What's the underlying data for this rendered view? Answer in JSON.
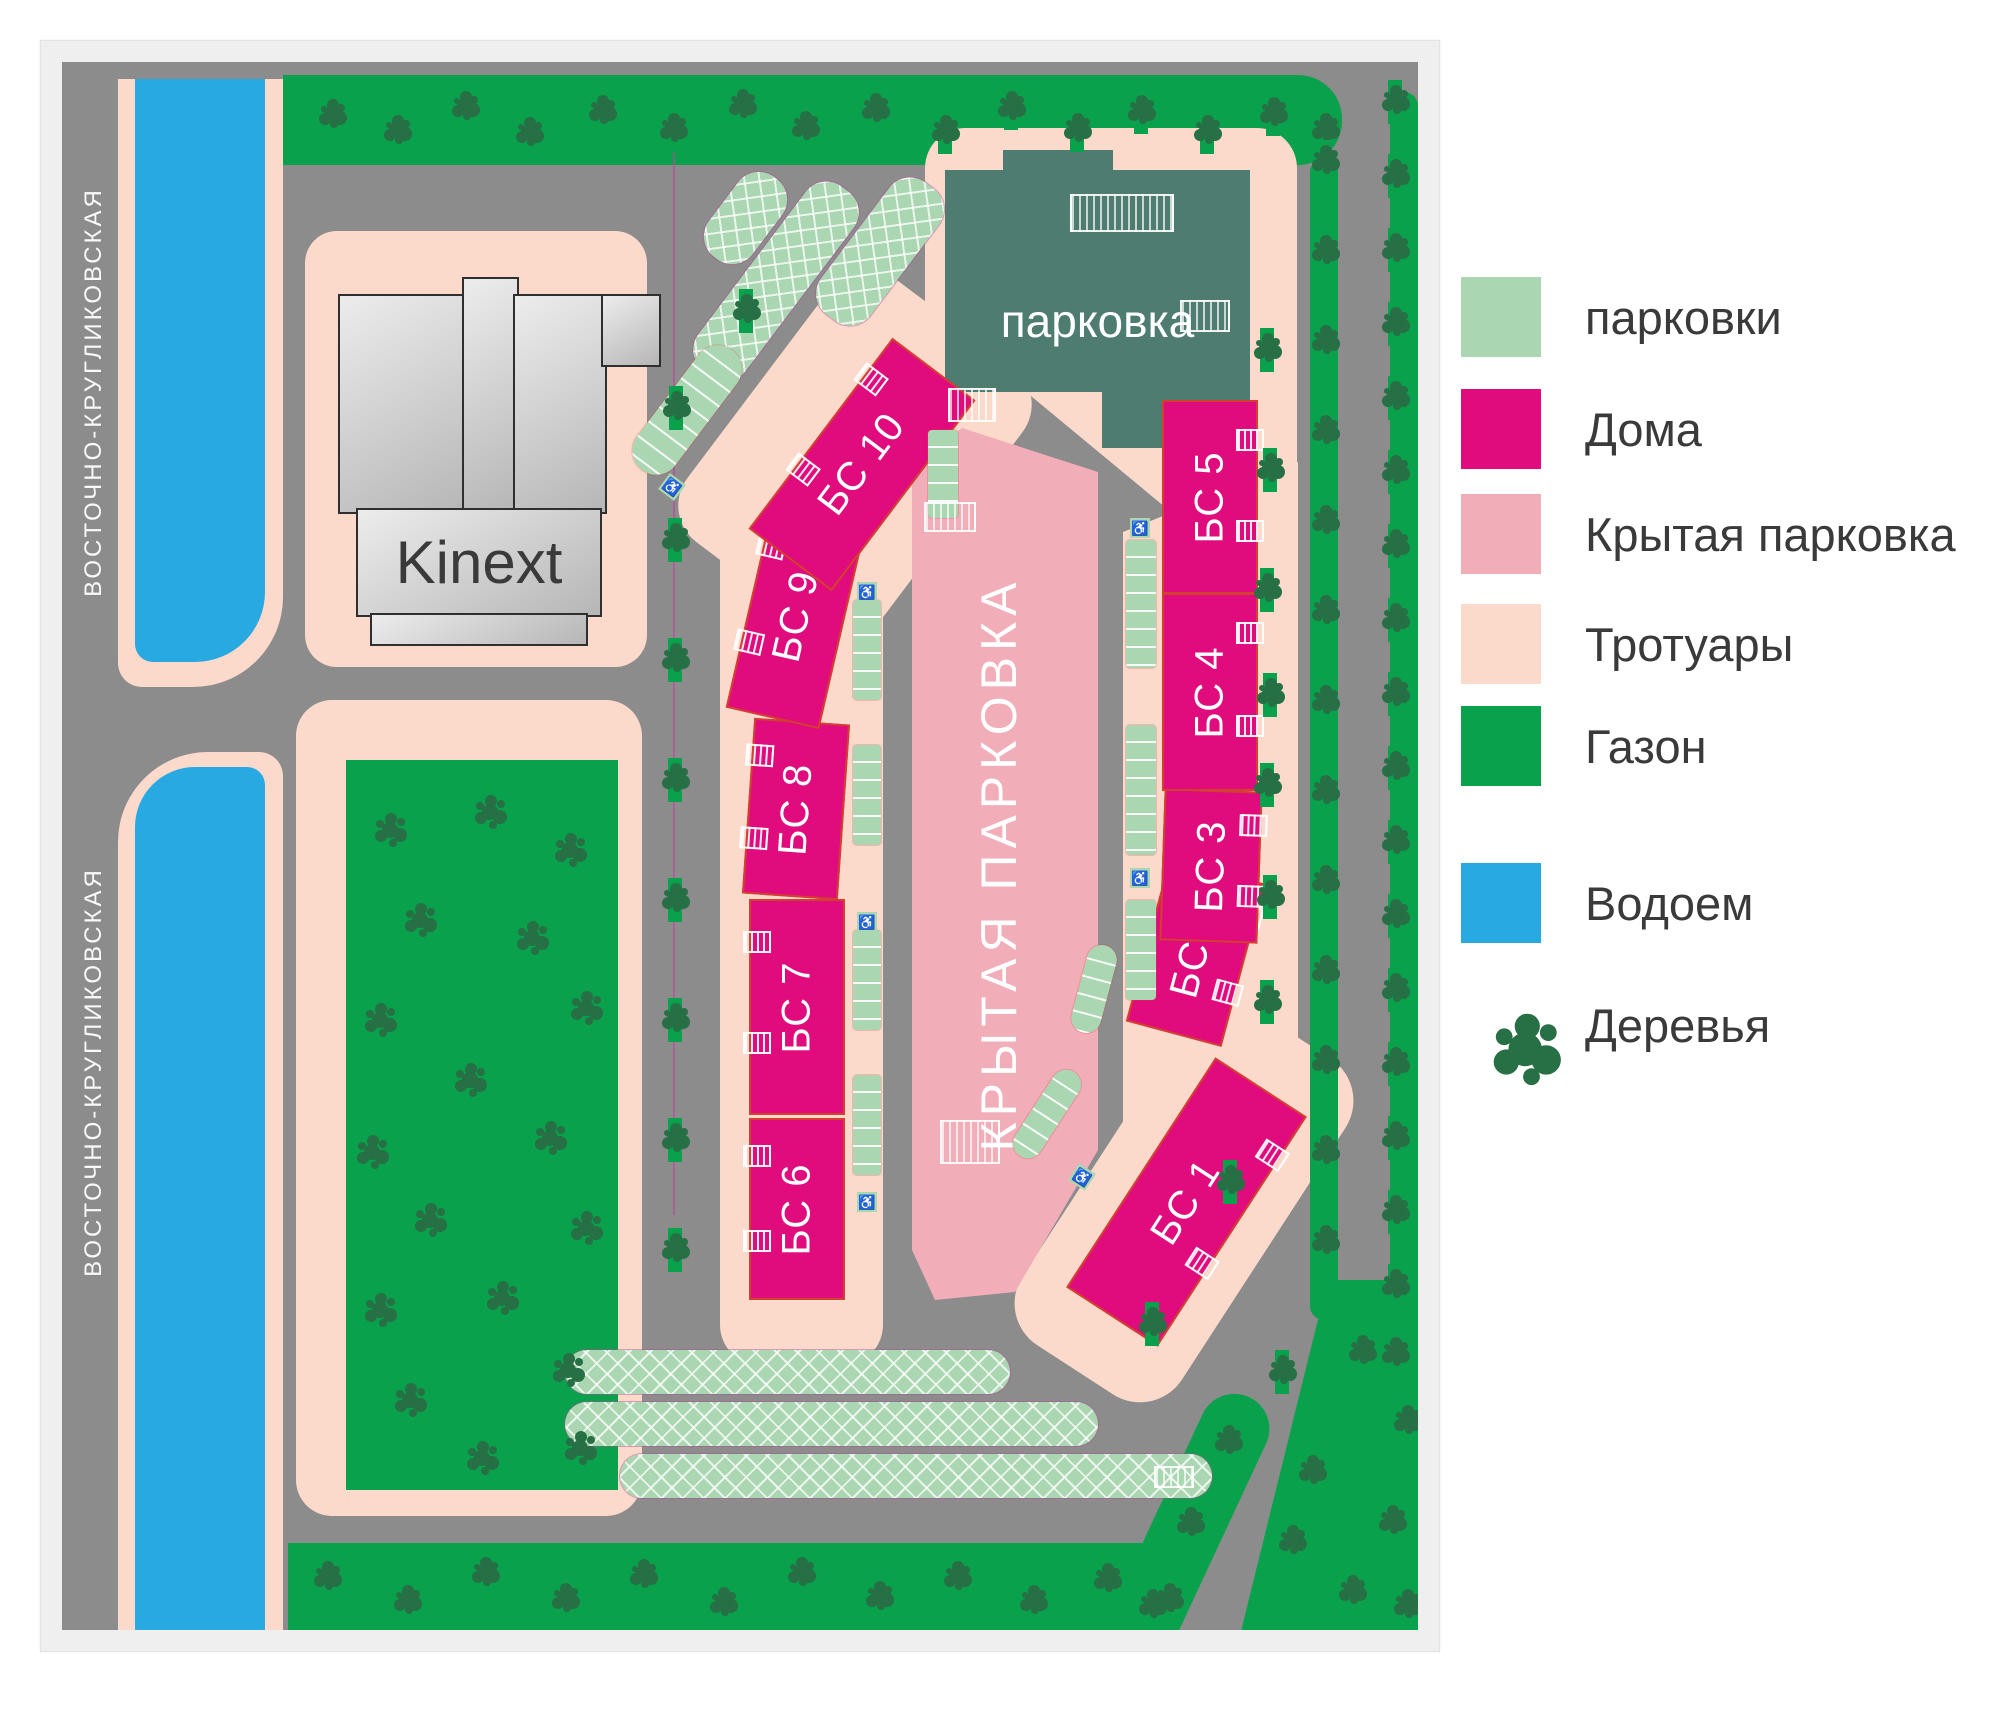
{
  "map": {
    "street_label": "ВОСТОЧНО-КРУГЛИКОВСКАЯ",
    "kinext_label": "Kinext",
    "parking_building_label": "парковка",
    "covered_parking_label": "КРЫТАЯ ПАРКОВКА",
    "buildings": [
      {
        "id": "bs-1",
        "label": "БС 1"
      },
      {
        "id": "bs-2",
        "label": "БС 2"
      },
      {
        "id": "bs-3",
        "label": "БС 3"
      },
      {
        "id": "bs-4",
        "label": "БС 4"
      },
      {
        "id": "bs-5",
        "label": "БС 5"
      },
      {
        "id": "bs-6",
        "label": "БС 6"
      },
      {
        "id": "bs-7",
        "label": "БС 7"
      },
      {
        "id": "bs-8",
        "label": "БС 8"
      },
      {
        "id": "bs-9",
        "label": "БС 9"
      },
      {
        "id": "bs-10",
        "label": "БС 10"
      }
    ]
  },
  "legend": {
    "items": [
      {
        "id": "parking",
        "label": "парковки",
        "type": "square",
        "color": "#aad6b2"
      },
      {
        "id": "houses",
        "label": "Дома",
        "type": "square",
        "color": "#e00b7d"
      },
      {
        "id": "covered-parking",
        "label": "Крытая парковка",
        "type": "square",
        "color": "#f1adb8"
      },
      {
        "id": "sidewalks",
        "label": "Тротуары",
        "type": "square",
        "color": "#fcdacb"
      },
      {
        "id": "lawn",
        "label": "Газон",
        "type": "square",
        "color": "#0aa14c"
      },
      {
        "id": "water",
        "label": "Водоем",
        "type": "square",
        "color": "#29a9e2"
      },
      {
        "id": "trees",
        "label": "Деревья",
        "type": "tree",
        "color": "#276f44"
      }
    ]
  },
  "colors": {
    "road": "#8c8c8c",
    "lawn": "#0aa14c",
    "tree": "#276f44",
    "water": "#29a9e2",
    "sidewalk": "#fcdacb",
    "covered": "#f1adb8",
    "house": "#e00b7d",
    "parking": "#aad6b2",
    "teal_building": "#4e7c71",
    "outline": "#d3402f",
    "boundary": "#b5499c"
  },
  "icons": {
    "wheelchair": "♿"
  }
}
